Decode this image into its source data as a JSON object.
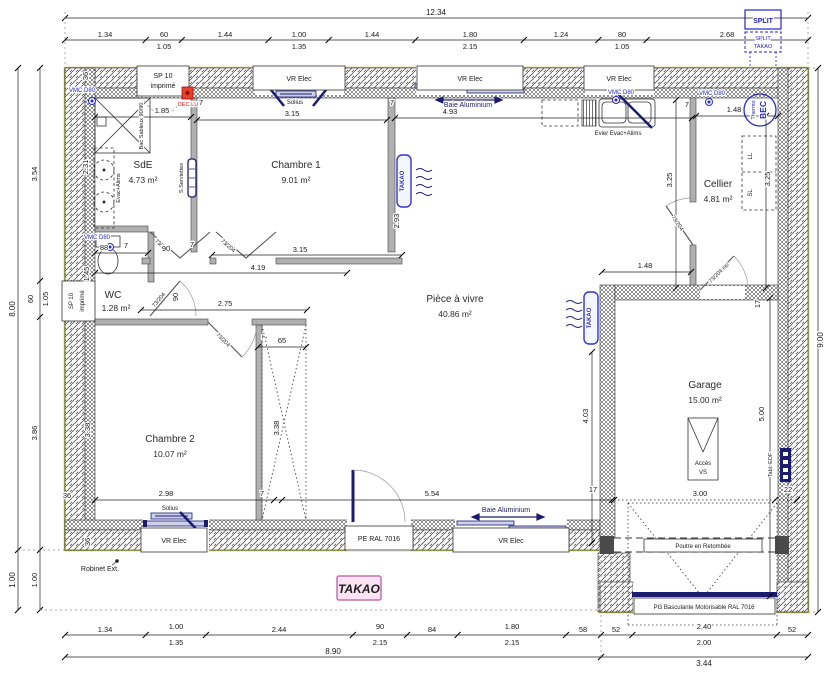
{
  "plan": {
    "stamp": "TAKAO",
    "split_unit": {
      "line1": "SPLIT",
      "line2": "SPLIT",
      "line3": "TAKAO"
    },
    "rooms": {
      "sde": {
        "name": "SdE",
        "area": "4.73 m²"
      },
      "ch1": {
        "name": "Chambre 1",
        "area": "9.01 m²"
      },
      "wc": {
        "name": "WC",
        "area": "1.28 m²"
      },
      "ch2": {
        "name": "Chambre 2",
        "area": "10.07 m²"
      },
      "sejour": {
        "name": "Pièce à vivre",
        "area": "40.86 m²"
      },
      "cellier": {
        "name": "Cellier",
        "area": "4.81 m²"
      },
      "garage": {
        "name": "Garage",
        "area": "15.00 m²"
      }
    },
    "openings": {
      "vr_elec": "VR Elec",
      "sp10_l1": "SP 10",
      "sp10_l2": "imprimé",
      "baie": "Baie Aluminium",
      "solius": "Solius",
      "pe": "PE RAL 7016",
      "pg": "PG Basculante Motorisable RAL 7016",
      "door": "73/204",
      "door_iso": "73/204 iso"
    },
    "equipment": {
      "takao_rad": "TAKAO",
      "vmc": "VMC D80",
      "bec1": "BEC",
      "bec2": "Thermo",
      "dec": "DEC.LU",
      "seche_serviettes": "S.Serviettes",
      "evier": "Evier Evac+Alims",
      "evac": "Evac+Alims",
      "bac": "Bac Sableux 90/90",
      "tabl_edf": "Tabl. EDF",
      "ll": "LL",
      "sl": "SL",
      "acces1": "Accès",
      "acces2": "VS",
      "poutre": "Poutre en Retombée",
      "robinet": "Robinet Ext."
    },
    "dims": {
      "top_total": "12.34",
      "top": [
        {
          "a": "1.34",
          "b": ""
        },
        {
          "a": "60",
          "b": "1.05"
        },
        {
          "a": "1.44",
          "b": ""
        },
        {
          "a": "1.00",
          "b": "1.35"
        },
        {
          "a": "1.44",
          "b": ""
        },
        {
          "a": "1.80",
          "b": "2.15"
        },
        {
          "a": "1.24",
          "b": ""
        },
        {
          "a": "80",
          "b": "1.05"
        },
        {
          "a": "2.68",
          "b": ""
        }
      ],
      "bottom": [
        {
          "a": "1.34",
          "b": ""
        },
        {
          "a": "1.00",
          "b": "1.35"
        },
        {
          "a": "2.44",
          "b": ""
        },
        {
          "a": "90",
          "b": "2.15"
        },
        {
          "a": "84",
          "b": ""
        },
        {
          "a": "1.80",
          "b": "2.15"
        },
        {
          "a": "58",
          "b": ""
        },
        {
          "a": "52",
          "b": ""
        },
        {
          "a": "2.40",
          "b": "2.00"
        },
        {
          "a": "52",
          "b": ""
        }
      ],
      "bottom_total_house": "8.90",
      "bottom_total_garage": "3.44",
      "left": [
        {
          "a": "3.54"
        },
        {
          "a": "60",
          "b": "1.05"
        },
        {
          "a": "3.86"
        },
        {
          "a": "1.00"
        }
      ],
      "left_total": "8.00",
      "left_total_low": "1.00",
      "right_total": "9.00",
      "i": {
        "d185": "1.85",
        "d315": "3.15",
        "d493": "4.93",
        "d148": "1.48",
        "d7": "7",
        "d231": "2.31",
        "d293": "2.93",
        "d325": "3.25",
        "d145": "1.45",
        "d88": "88",
        "d90": "90",
        "d419": "4.19",
        "d275": "2.75",
        "d65": "65",
        "d338": "3.38",
        "d298": "2.98",
        "d554": "5.54",
        "d17": "17",
        "d403": "4.03",
        "d300": "3.00",
        "d500": "5.00",
        "d22": "22",
        "d36": "36"
      }
    },
    "colors": {
      "wall_edge": "#b9bd52",
      "navy": "#1b1b6f",
      "blue": "#2626c4",
      "red": "#cc1f1f",
      "stamp_bg": "#fbe3f3",
      "stamp_border": "#c470ae"
    }
  }
}
